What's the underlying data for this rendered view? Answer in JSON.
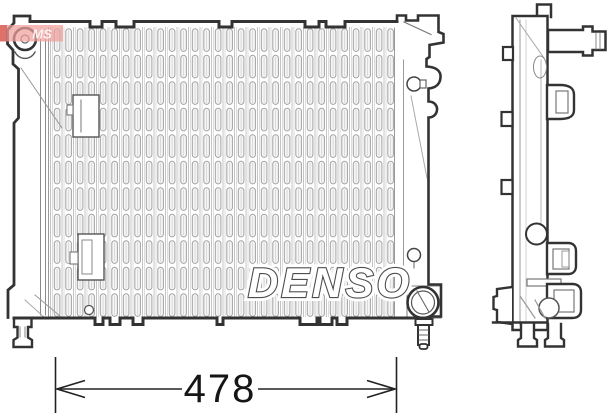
{
  "drawing": {
    "brand": "DENSO",
    "dimension": {
      "value": "478"
    },
    "watermark": {
      "text": "MS"
    },
    "colors": {
      "outline": "#333333",
      "detail_line": "#8a8a8a",
      "fin_line": "#c4c4c4",
      "fin_stroke": "#a2a2a2",
      "dimension_text": "#161616",
      "watermark_bg": "#ef9f9b",
      "watermark_edge": "#d95f57",
      "logo_fill": "#ffffff",
      "logo_stroke": "#4d4d4d",
      "background": "#ffffff"
    }
  }
}
